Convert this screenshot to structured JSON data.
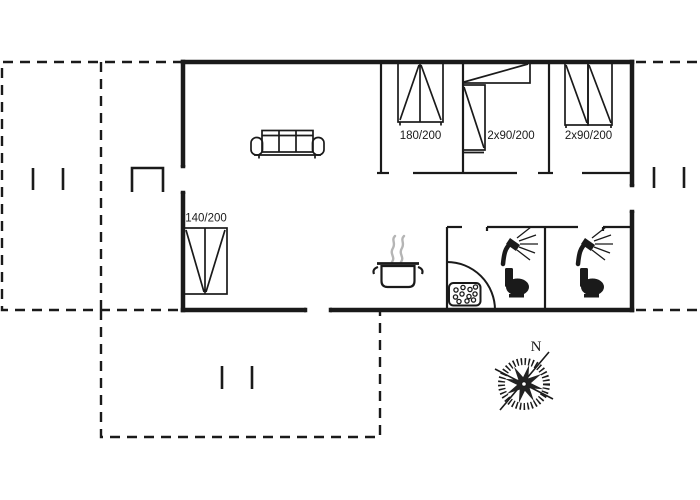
{
  "floorplan": {
    "beds": {
      "double": "180/200",
      "bunk_middle": "2x90/200",
      "bunk_right": "2x90/200",
      "single": "140/200"
    },
    "compass": {
      "north_label": "N"
    },
    "colors": {
      "line": "#1a1a1a",
      "steam": "#b5b5b5",
      "background": "#ffffff"
    }
  }
}
